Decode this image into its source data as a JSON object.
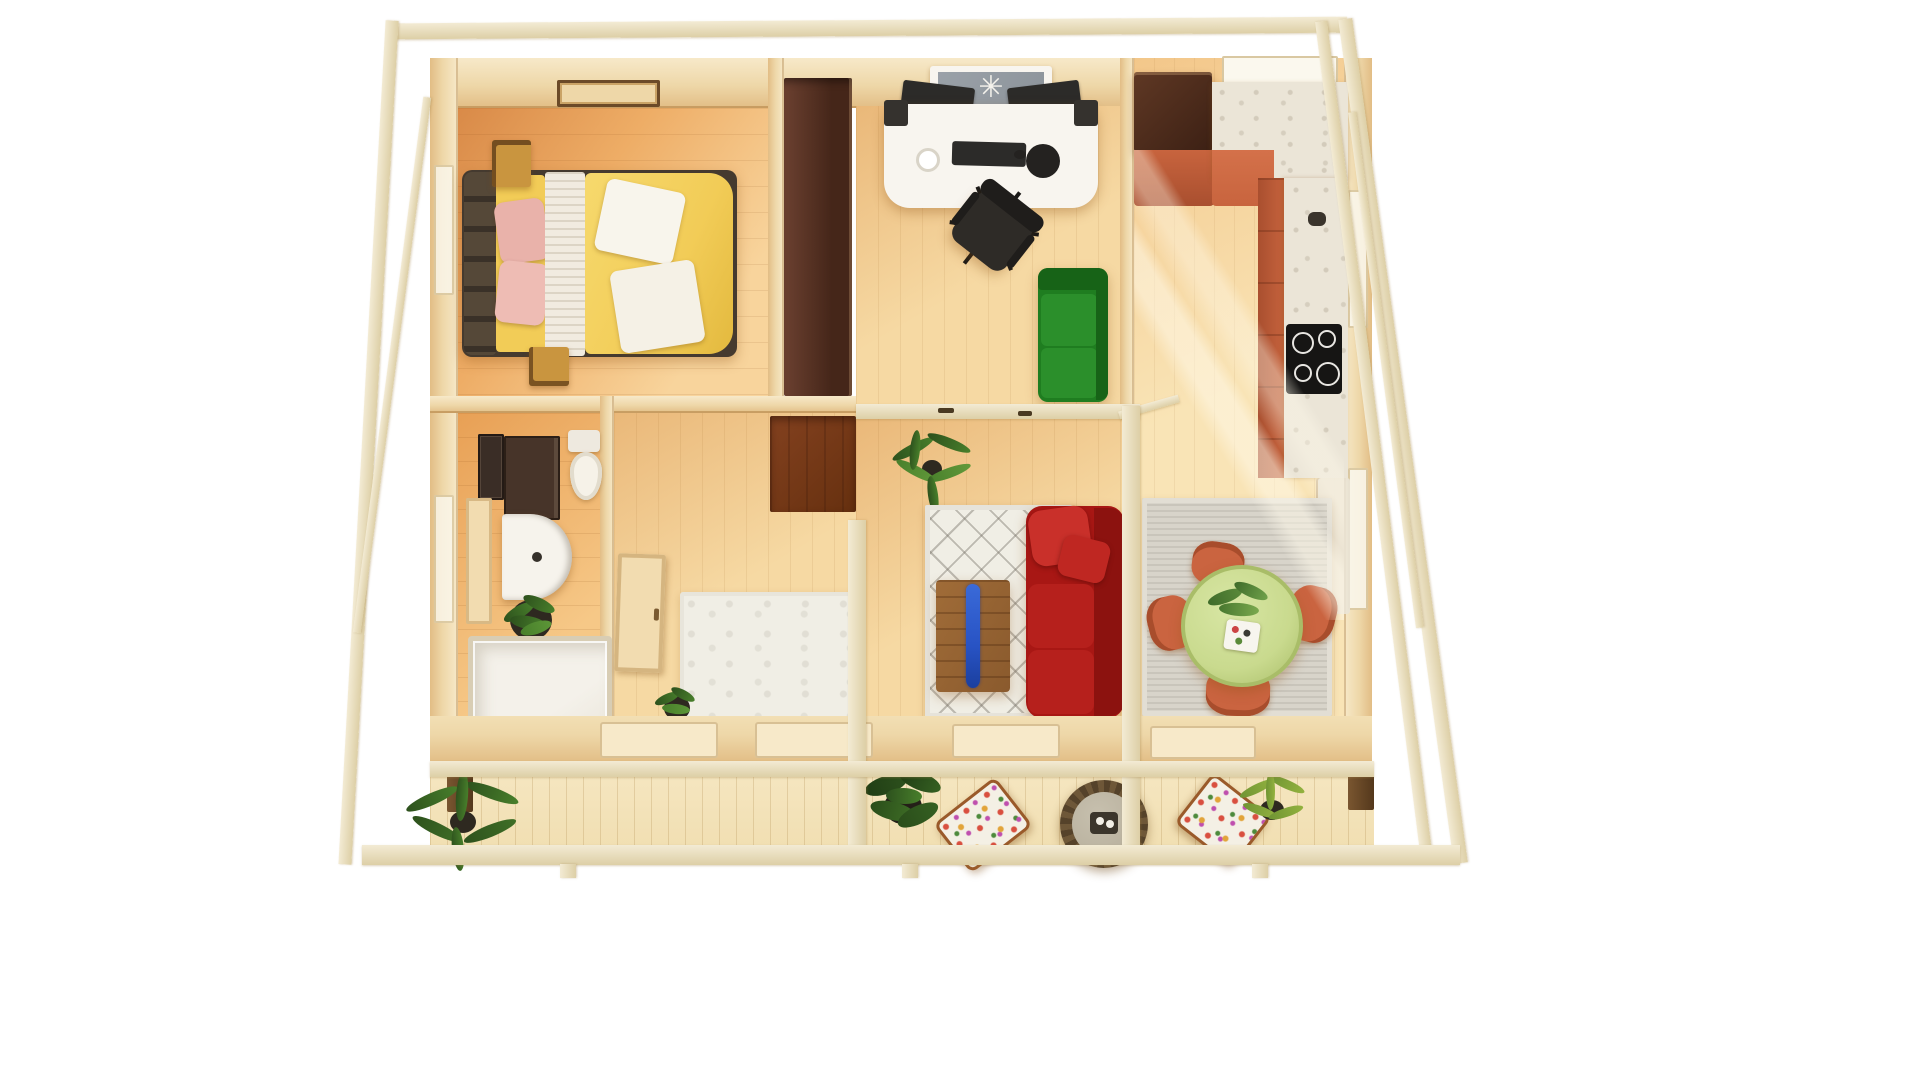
{
  "scene": {
    "kind": "3d-top-down-floorplan-render",
    "structure": "timber-frame-cabin-with-terrace"
  },
  "icons": {
    "ceiling_fan": "✳"
  },
  "palette": {
    "bg": "#ffffff",
    "frame": "#f3ebd4",
    "frameEdge": "#ddcfa6",
    "wallA": "#eed7a8",
    "wallB": "#e2bd85",
    "wallLight": "#f7e9c9",
    "windowWhite": "#fbf8ee",
    "floorBedA": "#d98a48",
    "floorBedB": "#f8d49c",
    "floorWarm": "#f6d9a3",
    "floorPale": "#f9e4b6",
    "floorBath": "#e8a055",
    "terrace": "#f1dfb2",
    "wardrobeA": "#6b4030",
    "wardrobeB": "#452619",
    "closet": "#83411f",
    "bedBase": "#453a2f",
    "headboard": "#554838",
    "sheet": "#f4edde",
    "pillowPink": "#e9b2aa",
    "throw": "#f1ebe0",
    "duvet": "#f2cc57",
    "blanket": "#f8f5ec",
    "nightstand": "#c9953f",
    "desk": "#f8f5ef",
    "deviceDark": "#2c2b29",
    "chairDark": "#2e2b27",
    "sofaGreen": "#1f7d20",
    "sofaGreenDark": "#176317",
    "sofaGreenLight": "#2b8f2b",
    "fridgeA": "#5f3824",
    "fridgeB": "#3c2014",
    "terracotta": "#c8643e",
    "terracottaDark": "#a94f2f",
    "marble": "#ebe5d7",
    "marbleVein": "#c9c2b1",
    "cooktop": "#161514",
    "burnerRing": "#e8e6e2",
    "glass": "#8d949b",
    "rugWhite": "#f0eee5",
    "rugGray": "#d8d4ca",
    "sofaRed": "#a81714",
    "sofaRedDark": "#8c120f",
    "sofaRedLight": "#c9302a",
    "woodTable": "#8a5a2d",
    "epoxy": "#2853c4",
    "tableGreen": "#c9da8e",
    "tableGreenEdge": "#a9bd68",
    "chairOrange": "#ca6440",
    "chairOrangeDark": "#a84d2c",
    "plantDark": "#2d511d",
    "plantMid": "#487f2b",
    "plantYellow": "#93b23f",
    "pot": "#2e2920",
    "wicker": "#55422a",
    "wickerLight": "#6e5738",
    "wickerTop": "#b5ad9a",
    "floralBase": "#f4f0e5",
    "woodFrame": "#9a5a2a",
    "doorWood": "#f2dcb0"
  },
  "rooms": [
    {
      "name": "bedroom",
      "furniture": [
        "double-bed",
        "tufted-headboard",
        "pink-pillows",
        "yellow-duvet",
        "white-throw",
        "white-blankets",
        "nightstand",
        "nightstand",
        "ceiling-vent",
        "wardrobe"
      ]
    },
    {
      "name": "office",
      "furniture": [
        "white-desk",
        "monitor",
        "monitor",
        "speaker",
        "speaker",
        "keyboard",
        "mouse-pad",
        "mug",
        "office-chair",
        "green-sofa",
        "window-with-fan"
      ]
    },
    {
      "name": "kitchen",
      "furniture": [
        "fridge-cabinet",
        "terracotta-counter",
        "marble-counter",
        "cooktop",
        "sink-tap",
        "window",
        "window-sill"
      ]
    },
    {
      "name": "bathroom",
      "furniture": [
        "mirror-cabinet",
        "vanity-cabinet",
        "rounded-sink-vanity",
        "toilet",
        "potted-plant",
        "shower-enclosure",
        "door-leaf"
      ]
    },
    {
      "name": "hallway",
      "furniture": [
        "white-rug",
        "dark-closet-floor",
        "open-door",
        "small-plant"
      ]
    },
    {
      "name": "living-room",
      "furniture": [
        "diamond-rug",
        "red-sofa",
        "epoxy-coffee-table",
        "palm-plant"
      ]
    },
    {
      "name": "dining-area",
      "furniture": [
        "gray-rug",
        "round-green-table",
        "table-plant",
        "serving-tray",
        "dining-chair",
        "dining-chair",
        "dining-chair",
        "dining-chair"
      ]
    },
    {
      "name": "terrace",
      "furniture": [
        "deck-planks",
        "palm-plant",
        "bush-plant",
        "floral-armchair",
        "round-wicker-table",
        "floral-armchair",
        "leafy-plant",
        "support-posts"
      ]
    }
  ]
}
